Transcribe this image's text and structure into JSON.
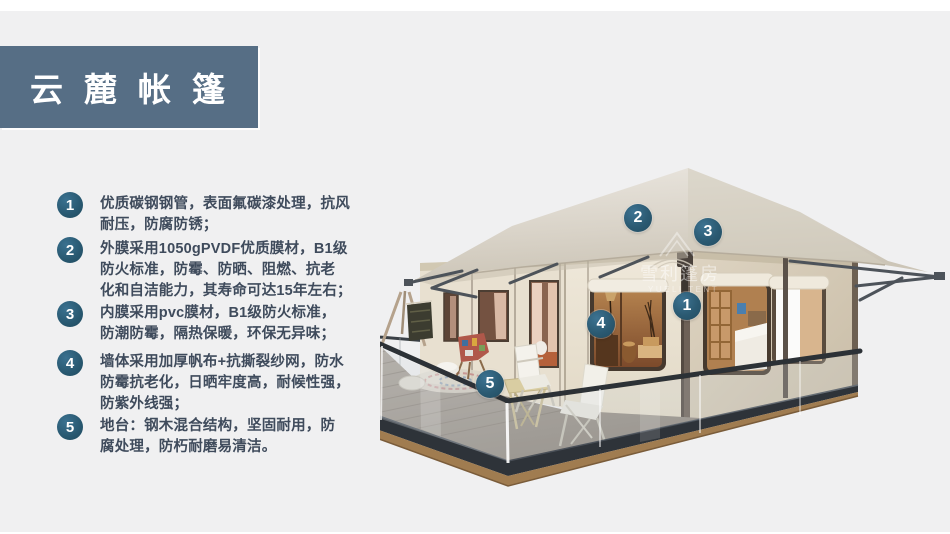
{
  "title": "云麓帐篷",
  "features": [
    {
      "num": "1",
      "text": "优质碳钢钢管，表面氟碳漆处理，抗风\n耐压，防腐防锈；"
    },
    {
      "num": "2",
      "text": "外膜采用1050gPVDF优质膜材，B1级\n防火标准，防霉、防晒、阻燃、抗老\n化和自洁能力，其寿命可达15年左右；"
    },
    {
      "num": "3",
      "text": "内膜采用pvc膜材，B1级防火标准，\n防潮防霉，隔热保暖，环保无异味；"
    },
    {
      "num": "4",
      "text": "墙体采用加厚帆布+抗撕裂纱网，防水\n防霉抗老化，日晒牢度高，耐候性强，\n防紫外线强；"
    },
    {
      "num": "5",
      "text": "地台：钢木混合结构，坚固耐用，防\n腐处理，防朽耐磨易清洁。"
    }
  ],
  "markers": [
    {
      "num": "1"
    },
    {
      "num": "2"
    },
    {
      "num": "3"
    },
    {
      "num": "4"
    },
    {
      "num": "5"
    }
  ],
  "watermark": {
    "cn": "雪利篷房",
    "en": "YUELI TENT"
  },
  "colors": {
    "accent_badge": "#2b5a72",
    "title_bar": "#566e85",
    "background": "#f0f0f1",
    "canvas_roof": "#d9d3c8",
    "wall_cream": "#ece5d6",
    "deck_gray": "#a39b92",
    "fascia_dark": "#2e3339"
  }
}
